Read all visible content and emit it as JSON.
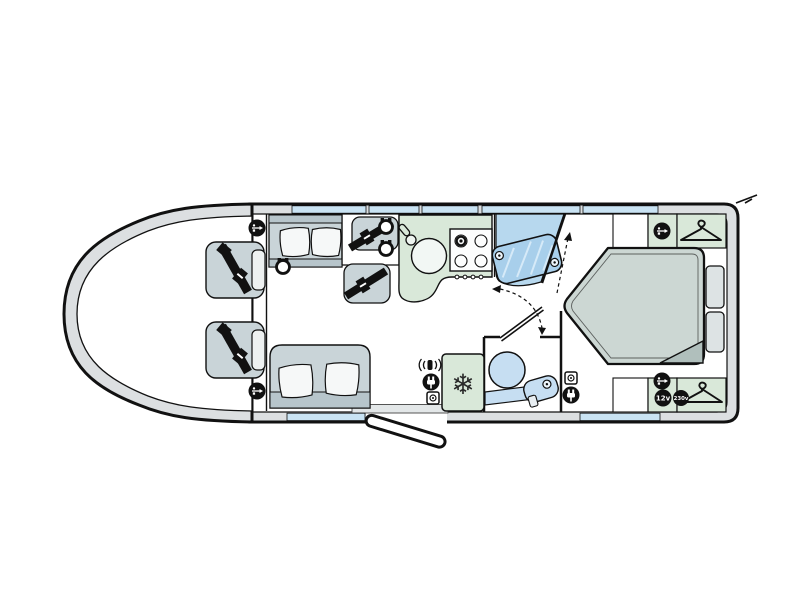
{
  "title": "Motorhome floor plan (top-down diagram)",
  "background": "#ffffff",
  "labels": {
    "v12": "12v",
    "v230": "230v"
  },
  "glyphs": {
    "snowflake": "❄"
  },
  "palette": {
    "outline": "#111111",
    "wall": "#dcdfe1",
    "window": "#c9e3f3",
    "upholstery": "#c9d4d8",
    "upholstery_dark": "#b7c5cb",
    "pillow": "#f6f8f8",
    "kitchen_green": "#d9e8d9",
    "shower_blue": "#b7d8ee",
    "shower_glass": "#a8cfeb",
    "sanitary_blue": "#c6def2",
    "bed": "#ccd7d3",
    "bed_fold": "#b0bfbc"
  },
  "areas": [
    "cab",
    "front-lounge",
    "travel-seats",
    "kitchen",
    "shower",
    "washroom",
    "fridge",
    "island-bed-bedroom",
    "wardrobes"
  ],
  "features": {
    "cab_belted_seats": 2,
    "travel_belted_seats": 2,
    "bench_sofas": 2,
    "hob_burners": 4,
    "sink": 1,
    "shower_cubicle": 1,
    "toilet": 1,
    "basin": 1,
    "fridge": 1,
    "island_bed": 1,
    "wardrobes": 2,
    "usb_points": 4,
    "speaker_points": 3,
    "mains_plug_points": 2,
    "mains_socket_points": 2,
    "tv_aerial_point": 1,
    "entry_door": 1
  }
}
